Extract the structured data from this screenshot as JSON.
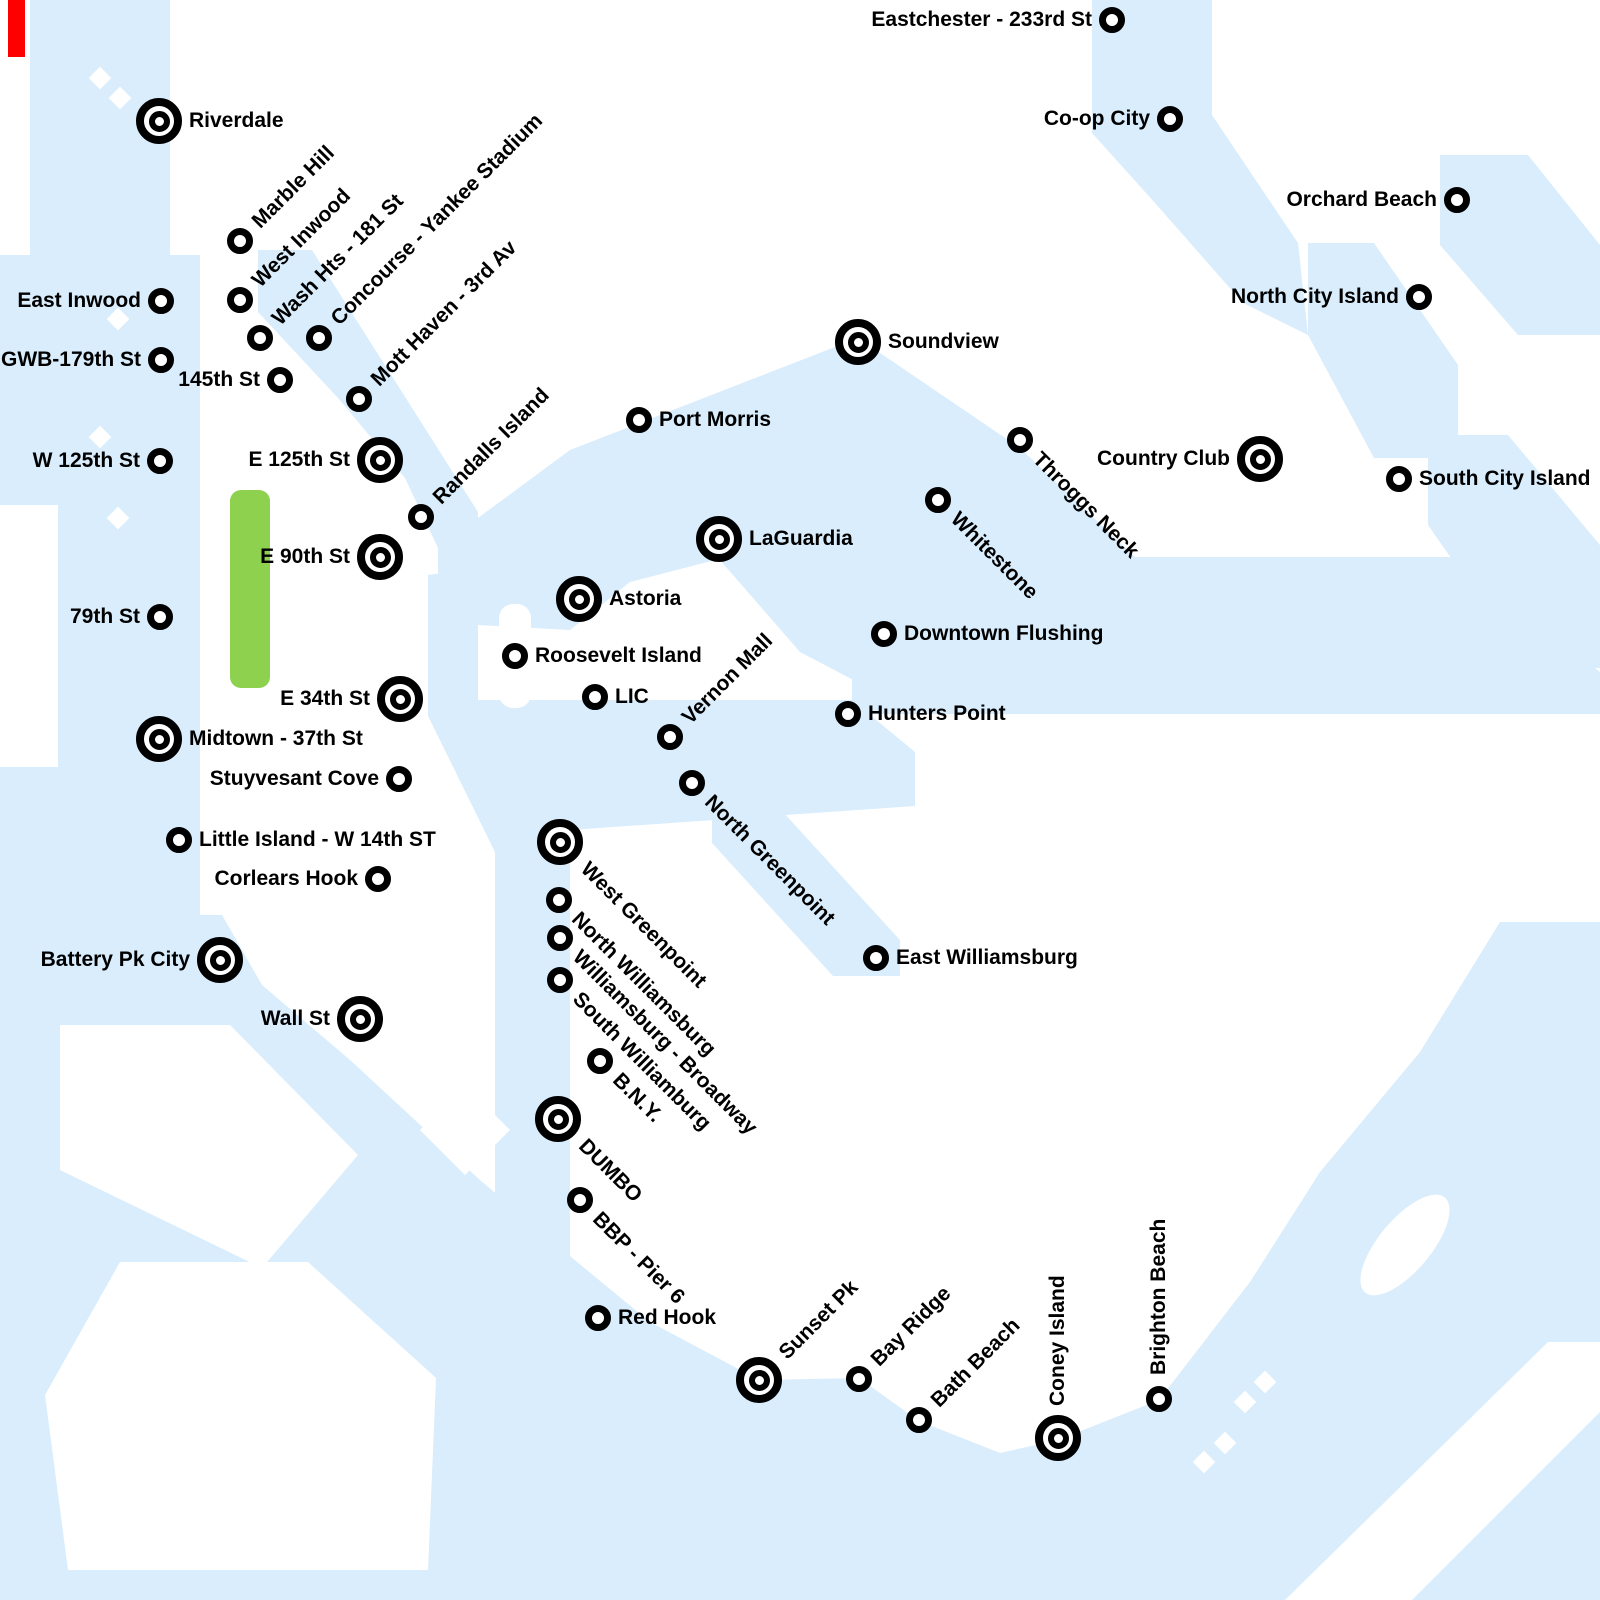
{
  "map": {
    "description": "NYC ferry network style map",
    "park_label": "",
    "colors": {
      "water": "#d9edfc",
      "land": "#ffffff",
      "park": "#8dd14f",
      "ink": "#000000",
      "alert": "#ff0000"
    },
    "marker_types": {
      "large": "terminal-bullseye-marker",
      "small": "stop-circle-marker"
    },
    "stations": [
      {
        "id": "eastchester-233rd-st",
        "label": "Eastchester - 233rd St",
        "marker": "small",
        "x": 1112,
        "y": 20,
        "side": "left"
      },
      {
        "id": "riverdale",
        "label": "Riverdale",
        "marker": "large",
        "x": 159,
        "y": 121,
        "side": "right"
      },
      {
        "id": "co-op-city",
        "label": "Co-op City",
        "marker": "small",
        "x": 1170,
        "y": 119,
        "side": "left"
      },
      {
        "id": "orchard-beach",
        "label": "Orchard Beach",
        "marker": "small",
        "x": 1457,
        "y": 200,
        "side": "left"
      },
      {
        "id": "marble-hill",
        "label": "Marble Hill",
        "marker": "small",
        "x": 240,
        "y": 241,
        "side": "diag_up"
      },
      {
        "id": "east-inwood",
        "label": "East Inwood",
        "marker": "small",
        "x": 161,
        "y": 301,
        "side": "left"
      },
      {
        "id": "west-inwood",
        "label": "West Inwood",
        "marker": "small",
        "x": 240,
        "y": 300,
        "side": "diag_up"
      },
      {
        "id": "north-city-island",
        "label": "North City Island",
        "marker": "small",
        "x": 1419,
        "y": 297,
        "side": "left"
      },
      {
        "id": "wash-hts-181-st",
        "label": "Wash Hts - 181 St",
        "marker": "small",
        "x": 260,
        "y": 338,
        "side": "diag_up"
      },
      {
        "id": "concourse-yankee-stadium",
        "label": "Concourse - Yankee Stadium",
        "marker": "small",
        "x": 319,
        "y": 338,
        "side": "diag_up"
      },
      {
        "id": "gwb-179th-st",
        "label": "GWB-179th St",
        "marker": "small",
        "x": 161,
        "y": 360,
        "side": "left"
      },
      {
        "id": "145th-st",
        "label": "145th St",
        "marker": "small",
        "x": 280,
        "y": 380,
        "side": "left"
      },
      {
        "id": "mott-haven-3rd-av",
        "label": "Mott Haven - 3rd Av",
        "marker": "small",
        "x": 359,
        "y": 399,
        "side": "diag_up"
      },
      {
        "id": "soundview",
        "label": "Soundview",
        "marker": "large",
        "x": 858,
        "y": 342,
        "side": "right"
      },
      {
        "id": "port-morris",
        "label": "Port Morris",
        "marker": "small",
        "x": 639,
        "y": 420,
        "side": "right"
      },
      {
        "id": "throggs-neck",
        "label": "Throggs Neck",
        "marker": "small",
        "x": 1020,
        "y": 440,
        "side": "diag_down"
      },
      {
        "id": "e-125th-st",
        "label": "E 125th St",
        "marker": "large",
        "x": 380,
        "y": 460,
        "side": "left"
      },
      {
        "id": "country-club",
        "label": "Country Club",
        "marker": "large",
        "x": 1260,
        "y": 459,
        "side": "left"
      },
      {
        "id": "w-125th-st",
        "label": "W 125th St",
        "marker": "small",
        "x": 160,
        "y": 461,
        "side": "left"
      },
      {
        "id": "south-city-island",
        "label": "South City Island",
        "marker": "small",
        "x": 1399,
        "y": 479,
        "side": "right"
      },
      {
        "id": "whitestone",
        "label": "Whitestone",
        "marker": "small",
        "x": 938,
        "y": 500,
        "side": "diag_down"
      },
      {
        "id": "randalls-island",
        "label": "Randalls Island",
        "marker": "small",
        "x": 421,
        "y": 517,
        "side": "diag_up"
      },
      {
        "id": "laguardia",
        "label": "LaGuardia",
        "marker": "large",
        "x": 719,
        "y": 539,
        "side": "right"
      },
      {
        "id": "e-90th-st",
        "label": "E 90th St",
        "marker": "large",
        "x": 380,
        "y": 557,
        "side": "left"
      },
      {
        "id": "astoria",
        "label": "Astoria",
        "marker": "large",
        "x": 579,
        "y": 599,
        "side": "right"
      },
      {
        "id": "79th-st",
        "label": "79th St",
        "marker": "small",
        "x": 160,
        "y": 617,
        "side": "left"
      },
      {
        "id": "downtown-flushing",
        "label": "Downtown Flushing",
        "marker": "small",
        "x": 884,
        "y": 634,
        "side": "right"
      },
      {
        "id": "roosevelt-island",
        "label": "Roosevelt Island",
        "marker": "small",
        "x": 515,
        "y": 656,
        "side": "right"
      },
      {
        "id": "lic",
        "label": "LIC",
        "marker": "small",
        "x": 595,
        "y": 697,
        "side": "right"
      },
      {
        "id": "e-34th-st",
        "label": "E 34th St",
        "marker": "large",
        "x": 400,
        "y": 699,
        "side": "left"
      },
      {
        "id": "hunters-point",
        "label": "Hunters Point",
        "marker": "small",
        "x": 848,
        "y": 714,
        "side": "right"
      },
      {
        "id": "midtown-37th-st",
        "label": "Midtown - 37th St",
        "marker": "large",
        "x": 159,
        "y": 739,
        "side": "right"
      },
      {
        "id": "vernon-mall",
        "label": "Vernon Mall",
        "marker": "small",
        "x": 670,
        "y": 737,
        "side": "diag_up"
      },
      {
        "id": "stuyvesant-cove",
        "label": "Stuyvesant Cove",
        "marker": "small",
        "x": 399,
        "y": 779,
        "side": "left"
      },
      {
        "id": "north-greenpoint",
        "label": "North Greenpoint",
        "marker": "small",
        "x": 692,
        "y": 783,
        "side": "diag_down"
      },
      {
        "id": "little-island-w-14th-st",
        "label": "Little Island - W 14th ST",
        "marker": "small",
        "x": 179,
        "y": 840,
        "side": "right"
      },
      {
        "id": "west-greenpoint",
        "label": "West Greenpoint",
        "marker": "large",
        "x": 560,
        "y": 842,
        "side": "diag_down"
      },
      {
        "id": "corlears-hook",
        "label": "Corlears Hook",
        "marker": "small",
        "x": 378,
        "y": 879,
        "side": "left"
      },
      {
        "id": "north-williamsburg",
        "label": "North Williamsburg",
        "marker": "small",
        "x": 559,
        "y": 900,
        "side": "diag_down"
      },
      {
        "id": "williamsburg-broadway",
        "label": "Williamsburg - Broadway",
        "marker": "small",
        "x": 560,
        "y": 938,
        "side": "diag_down"
      },
      {
        "id": "east-williamsburg",
        "label": "East Williamsburg",
        "marker": "small",
        "x": 876,
        "y": 958,
        "side": "right"
      },
      {
        "id": "battery-pk-city",
        "label": "Battery Pk City",
        "marker": "large",
        "x": 220,
        "y": 960,
        "side": "left"
      },
      {
        "id": "south-williamburg",
        "label": "South Williamburg",
        "marker": "small",
        "x": 560,
        "y": 980,
        "side": "diag_down"
      },
      {
        "id": "wall-st",
        "label": "Wall St",
        "marker": "large",
        "x": 360,
        "y": 1019,
        "side": "left"
      },
      {
        "id": "bny",
        "label": "B.N.Y.",
        "marker": "small",
        "x": 600,
        "y": 1061,
        "side": "diag_down"
      },
      {
        "id": "dumbo",
        "label": "DUMBO",
        "marker": "large",
        "x": 558,
        "y": 1119,
        "side": "diag_down"
      },
      {
        "id": "bbp-pier-6",
        "label": "BBP - Pier 6",
        "marker": "small",
        "x": 580,
        "y": 1200,
        "side": "diag_down"
      },
      {
        "id": "red-hook",
        "label": "Red Hook",
        "marker": "small",
        "x": 598,
        "y": 1318,
        "side": "right"
      },
      {
        "id": "sunset-pk",
        "label": "Sunset Pk",
        "marker": "large",
        "x": 759,
        "y": 1380,
        "side": "diag_up"
      },
      {
        "id": "bay-ridge",
        "label": "Bay Ridge",
        "marker": "small",
        "x": 859,
        "y": 1379,
        "side": "diag_up"
      },
      {
        "id": "bath-beach",
        "label": "Bath Beach",
        "marker": "small",
        "x": 919,
        "y": 1420,
        "side": "diag_up"
      },
      {
        "id": "coney-island",
        "label": "Coney Island",
        "marker": "large",
        "x": 1058,
        "y": 1438,
        "side": "vertical"
      },
      {
        "id": "brighton-beach",
        "label": "Brighton Beach",
        "marker": "small",
        "x": 1159,
        "y": 1399,
        "side": "vertical"
      }
    ]
  }
}
